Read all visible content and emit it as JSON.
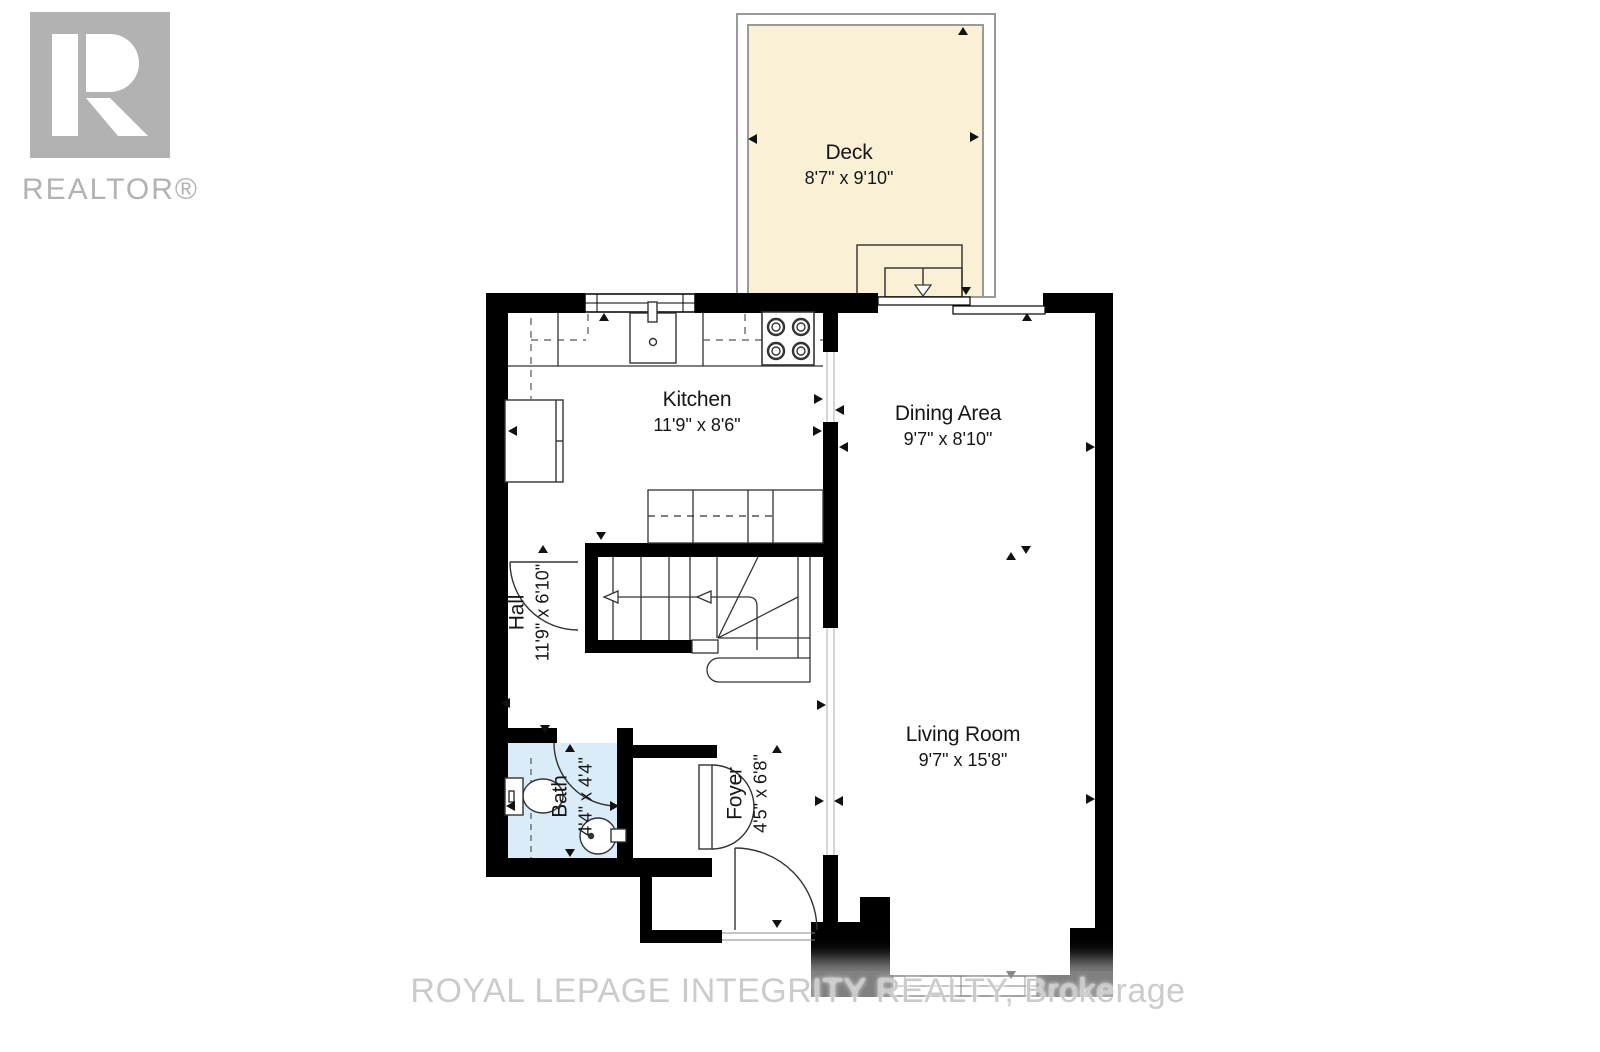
{
  "watermarks": {
    "realtor_logo_text": "REALTOR®",
    "brokerage_text": "ROYAL LEPAGE INTEGRITY REALTY, Brokerage"
  },
  "rooms": {
    "deck": {
      "name": "Deck",
      "dims": "8'7\" x 9'10\""
    },
    "kitchen": {
      "name": "Kitchen",
      "dims": "11'9\" x 8'6\""
    },
    "dining": {
      "name": "Dining Area",
      "dims": "9'7\" x 8'10\""
    },
    "hall": {
      "name": "Hall",
      "dims": "11'9\" x 6'10\""
    },
    "bath": {
      "name": "Bath",
      "dims": "4'4\" x 4'4\""
    },
    "foyer": {
      "name": "Foyer",
      "dims": "4'5\" x 6'8\""
    },
    "living": {
      "name": "Living Room",
      "dims": "9'7\" x 15'8\""
    }
  },
  "colors": {
    "deck_fill": "#faf0d5",
    "bath_fill": "#d9ecf8",
    "wall": "#000000",
    "watermark_gray": "#b2b2b2"
  }
}
